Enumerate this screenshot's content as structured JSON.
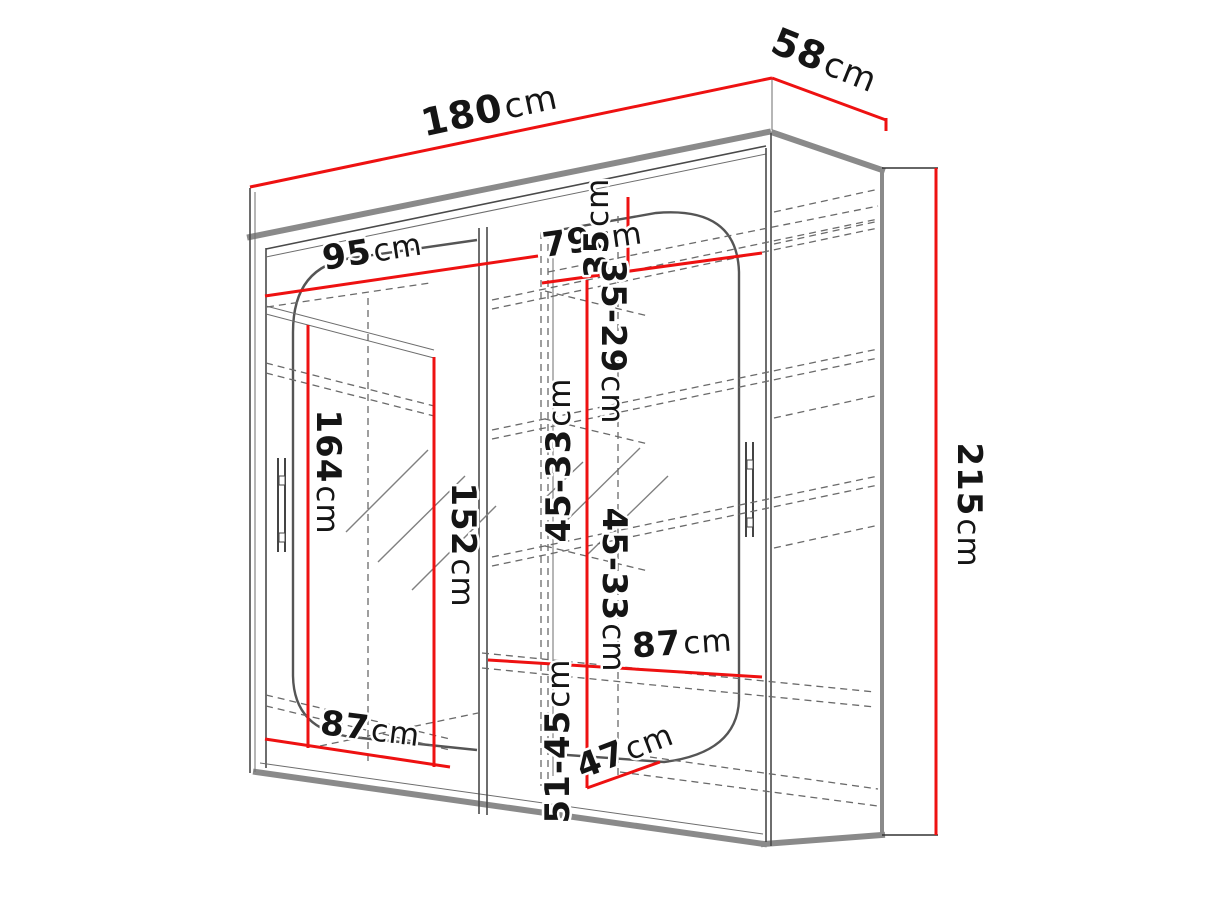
{
  "page": {
    "description": "Technical dimension diagram of a two-door sliding wardrobe with mirrors, drawn in perspective with red dimension lines",
    "background": "#ffffff"
  },
  "colors": {
    "dimension_line": "#ee1111",
    "outline_thick": "#8a8a8a",
    "outline_thin": "#4a4a4a",
    "hidden_line": "#6a6a6a",
    "label_text": "#151515"
  },
  "unit_default": "cm",
  "dimensions": {
    "width": {
      "value": "180",
      "unit": "cm"
    },
    "depth": {
      "value": "58",
      "unit": "cm"
    },
    "height": {
      "value": "215",
      "unit": "cm"
    },
    "left_section_width": {
      "value": "95",
      "unit": "cm"
    },
    "right_top_shelf_width": {
      "value": "79",
      "unit": "cm"
    },
    "top_shelf_height": {
      "value": "35",
      "unit": "cm"
    },
    "upper_shelf_spacing": {
      "value": "35-29",
      "unit": "cm"
    },
    "middle_shelf_spacing_left": {
      "value": "45-33",
      "unit": "cm"
    },
    "middle_shelf_spacing_right": {
      "value": "45-33",
      "unit": "cm"
    },
    "hanging_space_height": {
      "value": "164",
      "unit": "cm"
    },
    "mirror_door_height": {
      "value": "152",
      "unit": "cm"
    },
    "right_bottom_shelf_width": {
      "value": "87",
      "unit": "cm"
    },
    "left_bottom_width": {
      "value": "87",
      "unit": "cm"
    },
    "bottom_shelf_spacing": {
      "value": "51-45",
      "unit": "cm"
    },
    "bottom_shelf_depth": {
      "value": "47",
      "unit": "cm"
    }
  }
}
